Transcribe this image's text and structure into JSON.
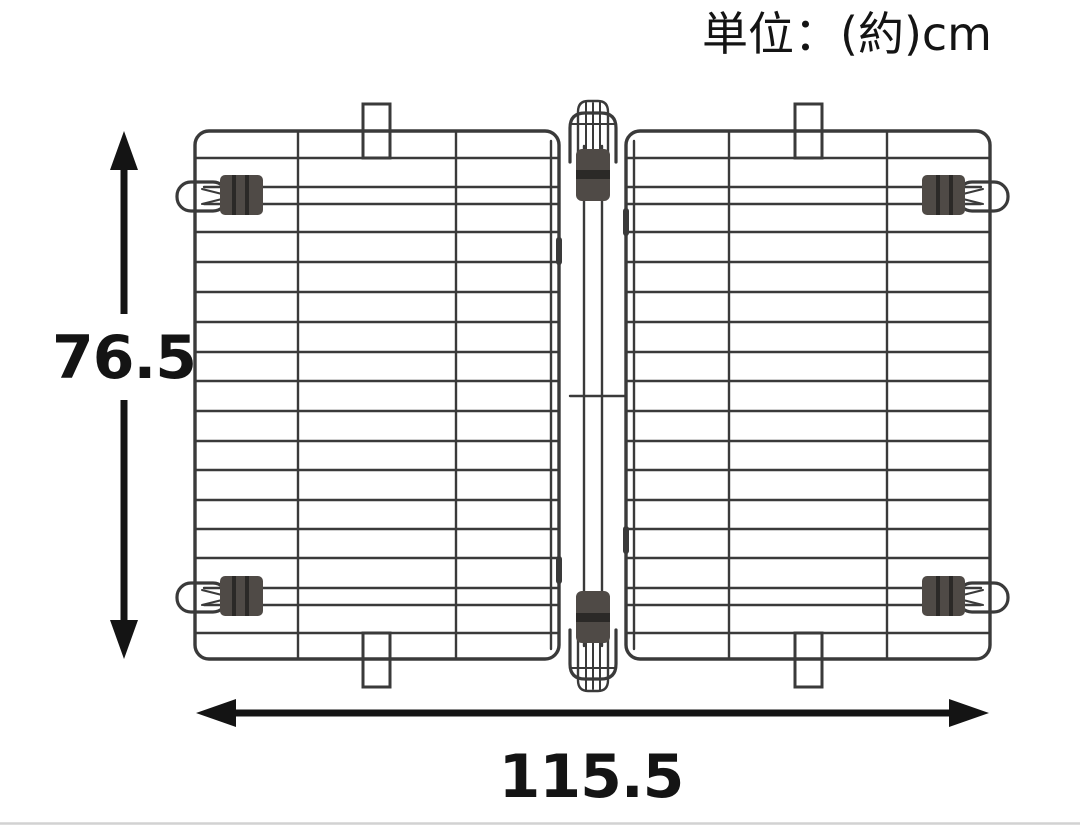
{
  "unit_note": {
    "text": "単位：(約)cm"
  },
  "dimensions": {
    "height_cm": "76.5",
    "width_cm": "115.5"
  },
  "colors": {
    "wire": "#3a3a3a",
    "clip": "#4f4a46",
    "clip_band": "#2b2927",
    "annotation": "#141414",
    "separator": "#d2d2d2"
  }
}
